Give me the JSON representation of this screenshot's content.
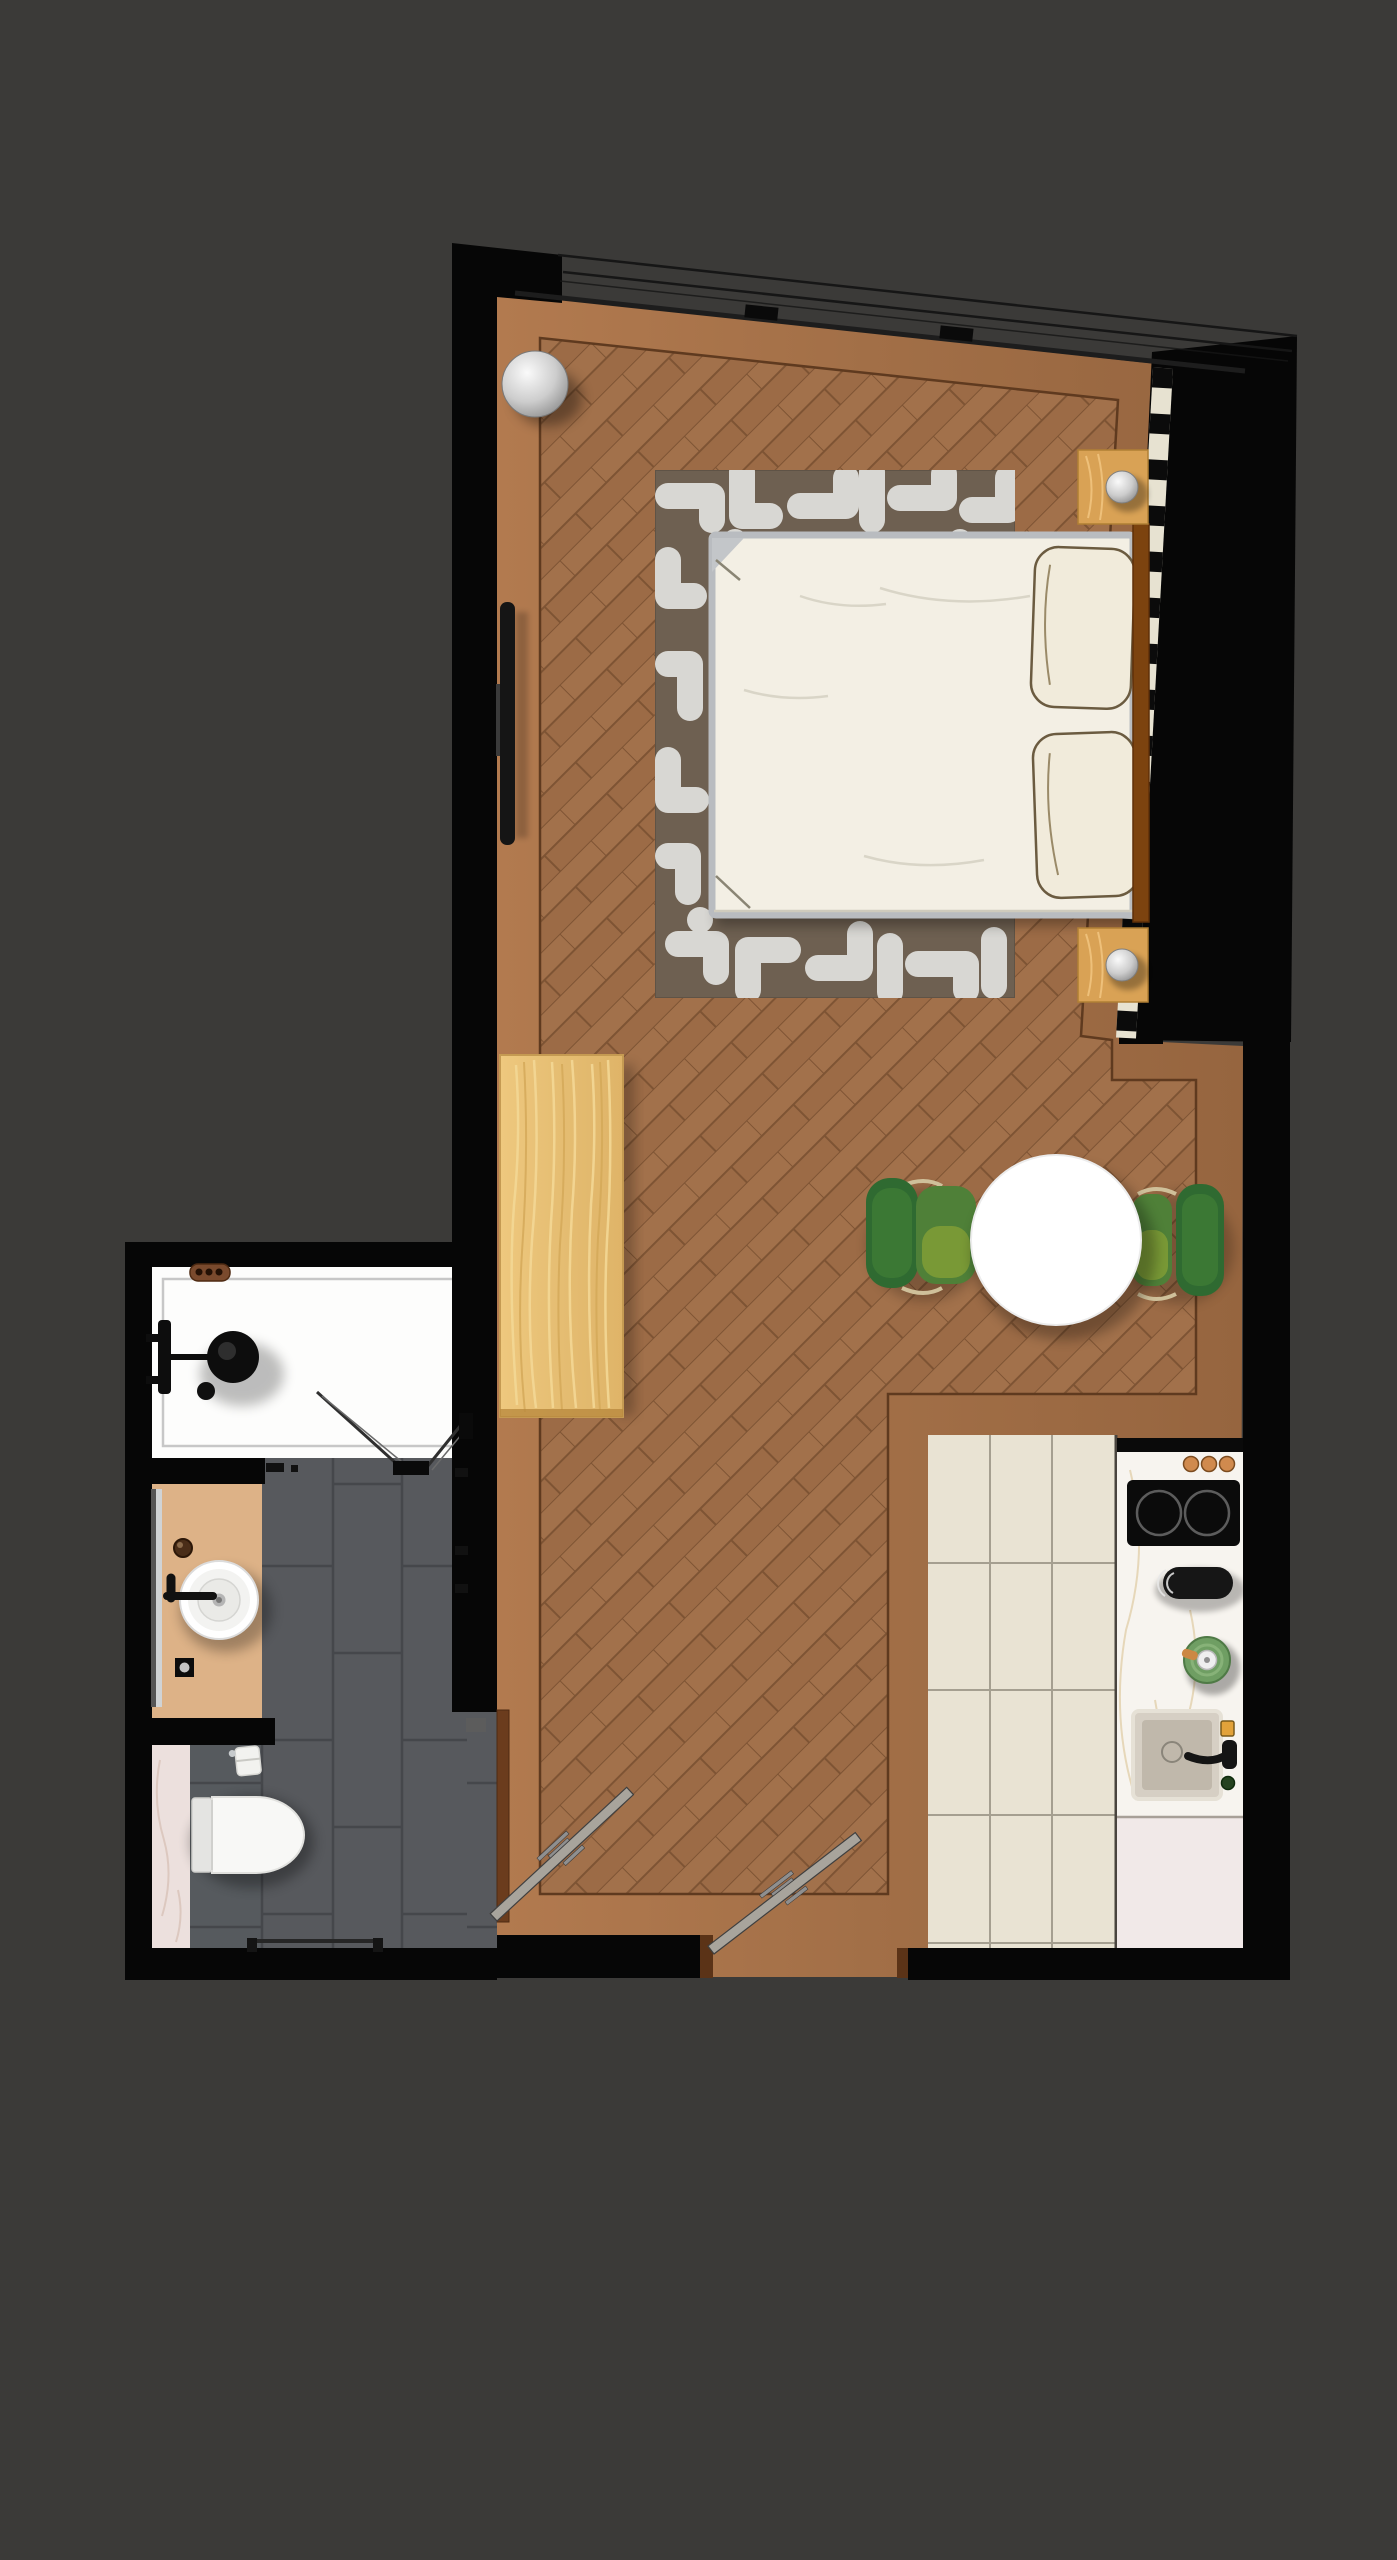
{
  "scene": {
    "type": "apartment-floor-plan",
    "view": "top-down",
    "rooms": [
      {
        "name": "main-room",
        "floor": "herringbone-wood-with-plank-border",
        "furniture": [
          "double-bed",
          "pillow",
          "pillow",
          "headboard",
          "area-rug",
          "nightstand-top",
          "nightstand-bottom",
          "sphere-lamp-top",
          "sphere-lamp-bottom",
          "decor-sphere",
          "wall-tv",
          "wardrobe",
          "round-dining-table",
          "dining-chair-left",
          "dining-chair-right"
        ],
        "openings": [
          "north-window-band",
          "east-window-strip",
          "entry-door",
          "bathroom-door"
        ]
      },
      {
        "name": "kitchen",
        "floor": "cream-ceramic-tiles",
        "furniture": [
          "counter",
          "cooktop",
          "counter-knobs",
          "black-mixer-tap",
          "plant-pot",
          "square-sink",
          "sink-faucet",
          "soap-bar",
          "pink-counter-slab"
        ]
      },
      {
        "name": "bathroom",
        "floor": "dark-slate-tiles",
        "furniture": [
          "walk-in-shower",
          "shower-head",
          "shower-glass-door",
          "vanity-counter",
          "round-vessel-sink",
          "wall-faucet",
          "mirror",
          "toilet",
          "toilet-paper-holder",
          "towel-rail",
          "pink-marble-strip"
        ]
      }
    ]
  },
  "palette": {
    "bg": "#3b3a38",
    "wall": "#060606",
    "floor_border": "#a9744c",
    "herringbone_base": "#9c6b46",
    "rug_base": "#6e6051",
    "rug_pattern": "#d8d7d3",
    "bed": "#f3efe4",
    "bed_frame": "#b9bcc0",
    "headboard": "#7c430f",
    "pillow": "#f1ebdb",
    "nightstand": "#d9a255",
    "wardrobe": "#e9c278",
    "table": "#ffffff",
    "chair_back": "#2f6a31",
    "chair_seat": "#4f8038",
    "chair_frame": "#cfc09a",
    "kitchen_tile": "#e9e3d3",
    "counter": "#f7f4ef",
    "cooktop": "#0b0b0b",
    "copper_knob": "#d08a4e",
    "plant": "#6f9e63",
    "sink_steel": "#d6cfc4",
    "pink_slab": "#f1e9e8",
    "bath_tile": "#57595d",
    "bath_grout": "#45474b",
    "shower": "#fdfdfc",
    "vanity": "#ddb287",
    "pink_floor": "#ece0dd",
    "door": "#a8a49c",
    "door_frame": "#6b3c1d",
    "window_strip": "#e7e2d1",
    "window_line": "#161616",
    "silver": "#cfcfcf"
  }
}
